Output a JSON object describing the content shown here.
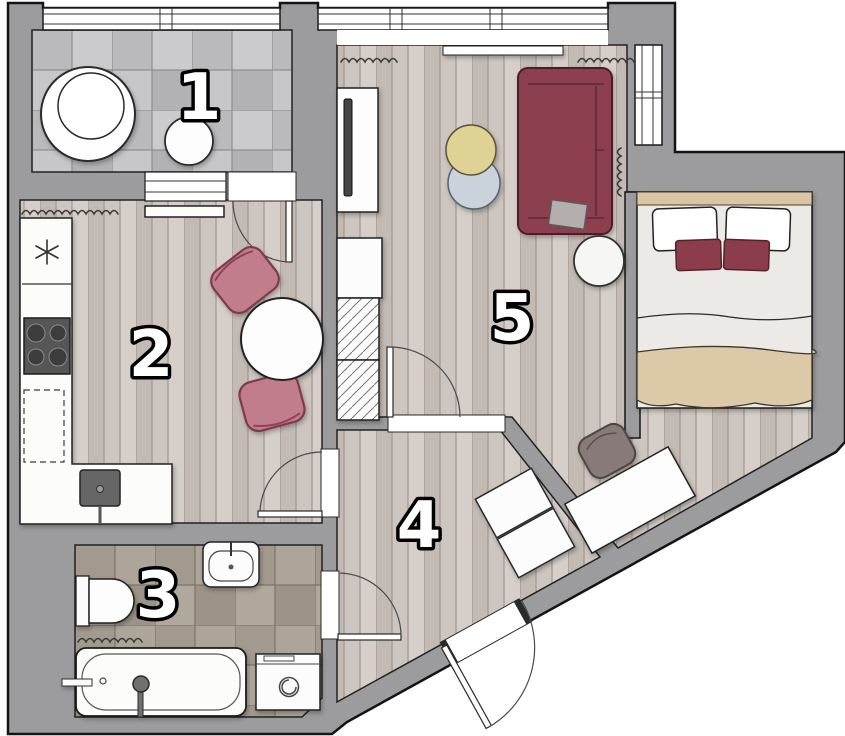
{
  "page": {
    "title": "Apartment Floor Plan"
  },
  "rooms": [
    {
      "label": "1"
    },
    {
      "label": "2"
    },
    {
      "label": "3"
    },
    {
      "label": "4"
    },
    {
      "label": "5"
    }
  ],
  "colors": {
    "background": "#ffffff",
    "wall": "#9c9c9e",
    "outline": "#1a1a1a",
    "wood_floor": "#cdc5bf",
    "loggia_tile": "#c3c3c5",
    "bathroom_tile": "#a8a094",
    "sofa_burgundy": "#8c4050",
    "chair_pink": "#c27d8d",
    "pillow_burgundy": "#8c3c4c",
    "blanket_tan": "#dcc9a8",
    "pouf_yellow": "#ded295",
    "pouf_blue": "#cad2dc",
    "desk_chair_taupe": "#897a7a"
  },
  "symbols": [
    "window",
    "door-swing",
    "radiator",
    "fridge",
    "stove",
    "kitchen-sink",
    "dining-table",
    "dining-chair",
    "round-table",
    "stool",
    "toilet",
    "wash-basin",
    "bathtub",
    "washing-machine",
    "hall-wardrobe",
    "tv",
    "tv-cabinet",
    "closet",
    "sofa",
    "cushion",
    "side-table",
    "pouf",
    "bed",
    "pillow",
    "desk",
    "desk-chair",
    "entry-door"
  ]
}
